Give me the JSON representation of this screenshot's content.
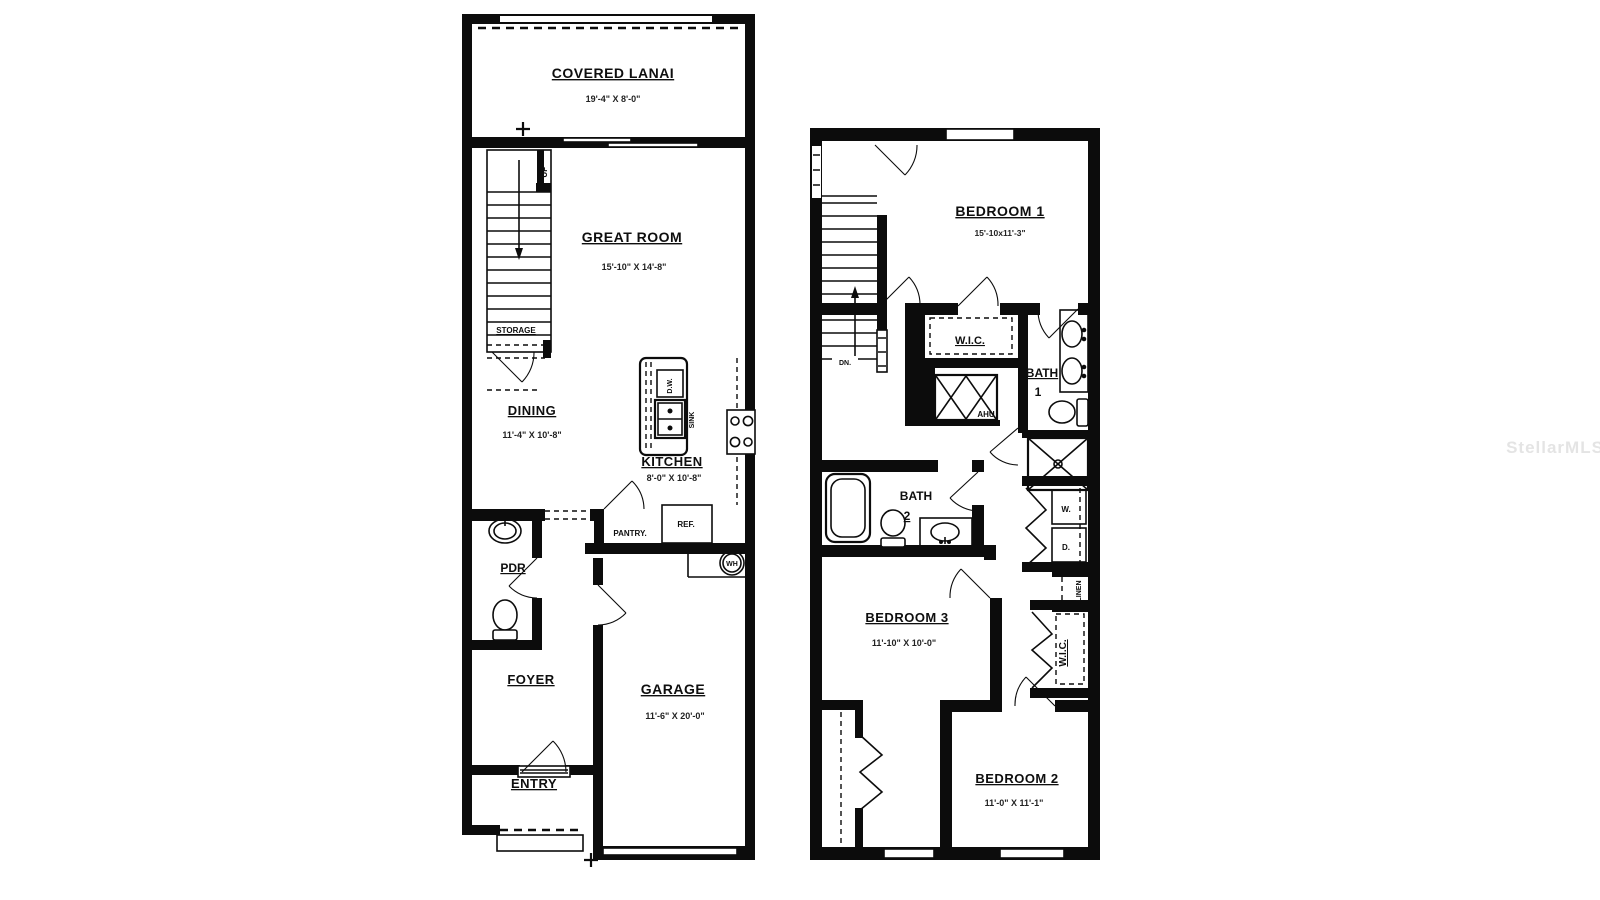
{
  "watermark": "StellarMLS",
  "floor1": {
    "lanai_name": "COVERED LANAI",
    "lanai_dims": "19'-4\" X 8'-0\"",
    "great_name": "GREAT ROOM",
    "great_dims": "15'-10\" X 14'-8\"",
    "dining_name": "DINING",
    "dining_dims": "11'-4\" X 10'-8\"",
    "kitchen_name": "KITCHEN",
    "kitchen_dims": "8'-0\" X 10'-8\"",
    "garage_name": "GARAGE",
    "garage_dims": "11'-6\" X 20'-0\"",
    "pdr": "PDR",
    "foyer": "FOYER",
    "entry": "ENTRY",
    "up": "UP",
    "storage": "STORAGE",
    "dw": "D.W.",
    "sink": "SINK",
    "pantry": "PANTRY.",
    "ref": "REF.",
    "wh": "WH"
  },
  "floor2": {
    "bedroom1_name": "BEDROOM 1",
    "bedroom1_dims": "15'-10x11'-3\"",
    "bedroom2_name": "BEDROOM 2",
    "bedroom2_dims": "11'-0\" X 11'-1\"",
    "bedroom3_name": "BEDROOM 3",
    "bedroom3_dims": "11'-10\" X 10'-0\"",
    "wic1": "W.I.C.",
    "wic2": "W.I.C.",
    "bath1_line1": "BATH",
    "bath1_line2": "1",
    "bath2_line1": "BATH",
    "bath2_line2": "2",
    "dn": "DN.",
    "ahu": "AHU",
    "washer": "W.",
    "dryer": "D.",
    "linen": "LINEN"
  }
}
